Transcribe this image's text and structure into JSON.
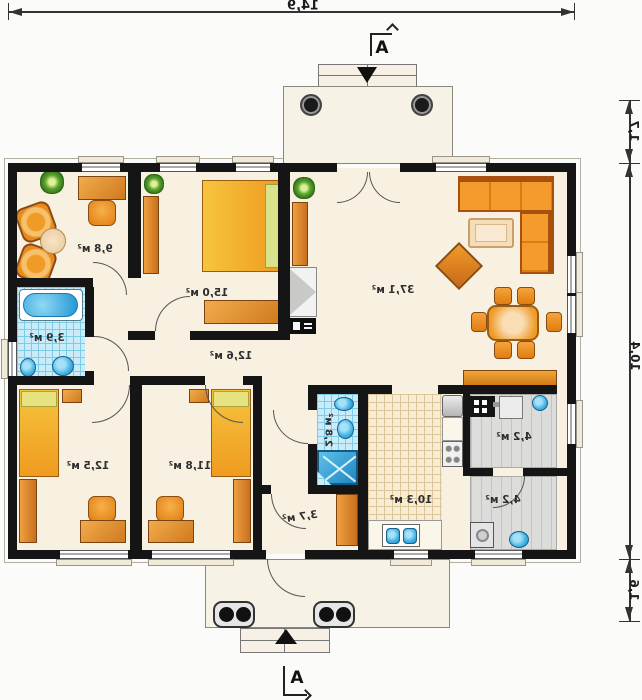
{
  "palette": {
    "wall": "#151515",
    "floor_cream": "#f8f1e1",
    "furniture_orange": "#ef9b20",
    "wood_brown": "#cf7a1d",
    "water_blue": "#45b3e3",
    "tile_blue": "#c9ecf8",
    "kitchen_tile": "#f7ecd4",
    "utility_gray": "#dcdcda"
  },
  "dimensions": {
    "overall_width": "14,9",
    "porch_depth": "1,7",
    "overall_depth": "10,4",
    "terrace_depth": "1,6"
  },
  "section": {
    "label": "A"
  },
  "rooms": {
    "office": {
      "area": "9,8 м²"
    },
    "bedroom_master": {
      "area": "15,0 м²"
    },
    "bathroom_main": {
      "area": "3,9 м²"
    },
    "hallway": {
      "area": "12,6 м²"
    },
    "living_room": {
      "area": "37,1 м²"
    },
    "bedroom_left": {
      "area": "12,5 м²"
    },
    "bedroom_middle": {
      "area": "11,8 м²"
    },
    "shower_room": {
      "area": "2,8 м²"
    },
    "vestibule": {
      "area": "3,7 м²"
    },
    "kitchen": {
      "area": "10,3 м²"
    },
    "utility_room": {
      "area": "4,2 м²"
    },
    "laundry_room": {
      "area": "4,2 м²"
    }
  }
}
